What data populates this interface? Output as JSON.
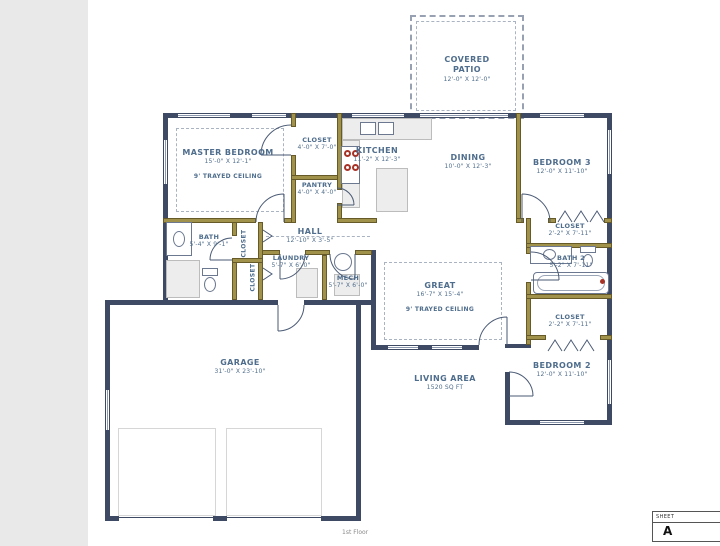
{
  "colors": {
    "exterior_wall": "#3e4a63",
    "interior_wall": "#a0924b",
    "label_text": "#4f6d8c",
    "accent_red": "#a93226",
    "paper": "#ffffff"
  },
  "rooms": [
    {
      "name": "MASTER BEDROOM",
      "dims": "15'-0\" X 12'-1\"",
      "note": "9' TRAYED CEILING"
    },
    {
      "name": "CLOSET",
      "dims": "4'-0\" X 7'-0\""
    },
    {
      "name": "PANTRY",
      "dims": "4'-0\" X 4'-0\""
    },
    {
      "name": "KITCHEN",
      "dims": "11'-2\" X 12'-3\""
    },
    {
      "name": "DINING",
      "dims": "10'-0\" X 12'-3\""
    },
    {
      "name": "COVERED PATIO",
      "dims": "12'-0\" X 12'-0\""
    },
    {
      "name": "BEDROOM 3",
      "dims": "12'-0\" X 11'-10\""
    },
    {
      "name": "BATH",
      "dims": "5'-4\" X 9'-1\""
    },
    {
      "name": "CLOSET",
      "dims": ""
    },
    {
      "name": "CLOSET",
      "dims": ""
    },
    {
      "name": "HALL",
      "dims": "12'-10\" X 3'-5\""
    },
    {
      "name": "LAUNDRY",
      "dims": "5'-7\" X 6'-0\""
    },
    {
      "name": "MECH",
      "dims": "5'-7\" X 6'-0\""
    },
    {
      "name": "GREAT",
      "dims": "16'-7\" X 15'-4\"",
      "note": "9' TRAYED CEILING"
    },
    {
      "name": "CLOSET",
      "dims": "2'-2\" X 7'-11\""
    },
    {
      "name": "BATH 2",
      "dims": "5'-2\" X 7'-11\""
    },
    {
      "name": "CLOSET",
      "dims": "2'-2\" X 7'-11\""
    },
    {
      "name": "BEDROOM 2",
      "dims": "12'-0\" X 11'-10\""
    },
    {
      "name": "GARAGE",
      "dims": "31'-0\" X 23'-10\""
    }
  ],
  "living_area": {
    "label": "LIVING AREA",
    "value": "1520 SQ FT"
  },
  "footer": {
    "floor_label": "1st Floor"
  },
  "sheet": {
    "header": "SHEET",
    "number": "A"
  }
}
